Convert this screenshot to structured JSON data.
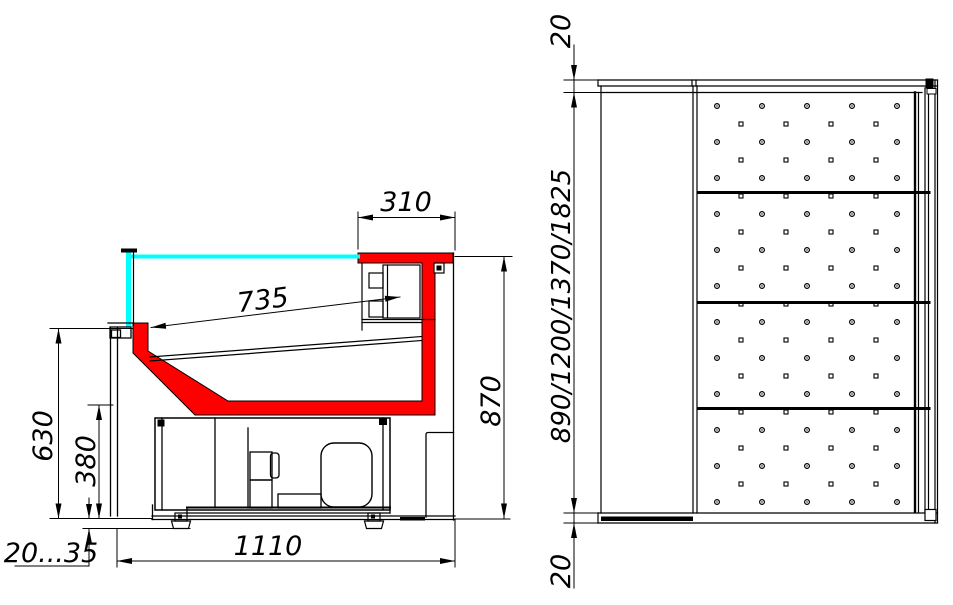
{
  "drawing": {
    "colors": {
      "accent_red": "#ff0000",
      "glass_cyan": "#00ffff",
      "line_black": "#000000",
      "background": "#ffffff"
    },
    "side_view": {
      "dim_canopy_depth": "310",
      "dim_display_surface": "735",
      "dim_overall_height": "870",
      "dim_front_height": "630",
      "dim_base_height": "380",
      "dim_overall_depth": "1110",
      "dim_foot_adjust": "20...35"
    },
    "top_view": {
      "dim_rear_overhang": "20",
      "dim_module_lengths": "890/1200/1370/1825",
      "dim_front_overhang": "20"
    }
  }
}
